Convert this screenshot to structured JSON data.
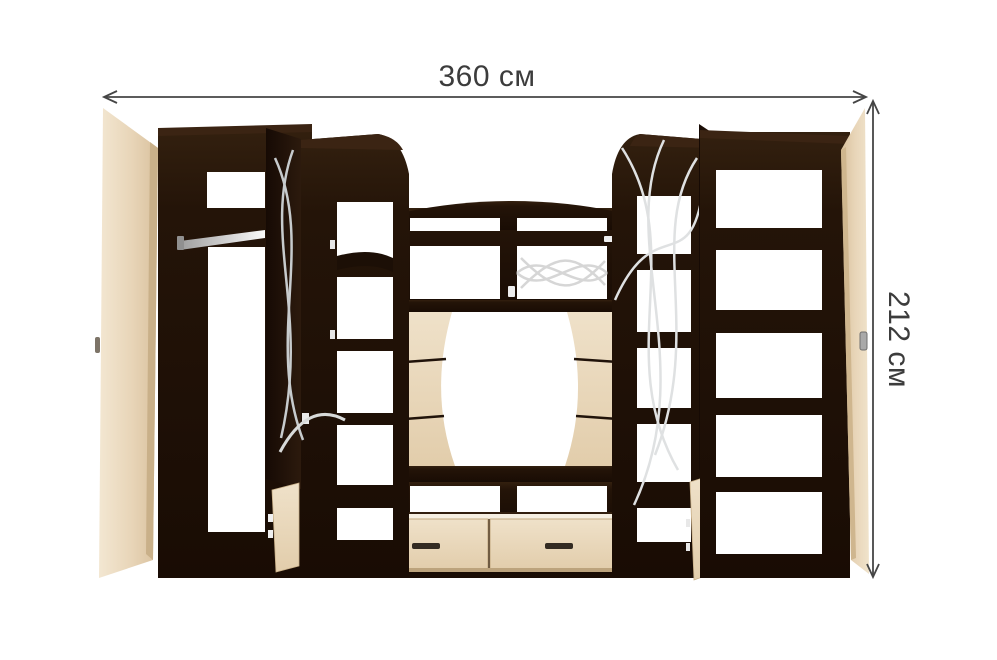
{
  "page": {
    "type": "furniture dimension diagram",
    "background": "#ffffff"
  },
  "annotations": {
    "width": {
      "label": "360 см",
      "value": "360",
      "unit": "см",
      "orientation": "horizontal"
    },
    "height": {
      "label": "212 см",
      "value": "212",
      "unit": "см",
      "orientation": "vertical"
    },
    "line_color": "#454545",
    "text_color": "#3c3c3c"
  },
  "furniture": {
    "kind": "living-room wall unit with wardrobe, TV niche and shelving",
    "colors": {
      "carcass_dark": "#241309",
      "carcass_highlight": "#3b2413",
      "front_beige": "#ecdcc2",
      "beige_edge": "#c9b089",
      "metal_rail": "#c8c8c8",
      "glass_decor": "#d6d6d6",
      "drawer_handle": "#332b22"
    },
    "parts": {
      "left_door": "open hinged door, light front",
      "wardrobe": "open wardrobe with top shelf and hanging rail",
      "left_tower": "display column with open dark door, curved shelves, open lower cabinet",
      "center": "arched top shelf, shelf cells with glass decor, TV niche with shaped light back panel, two drawers",
      "right_tower": "display column with curved glass decor, open lower cabinet",
      "bookcase": "open shelving with five cells",
      "right_door": "open hinged door, light front"
    },
    "drawer_count": "2"
  }
}
